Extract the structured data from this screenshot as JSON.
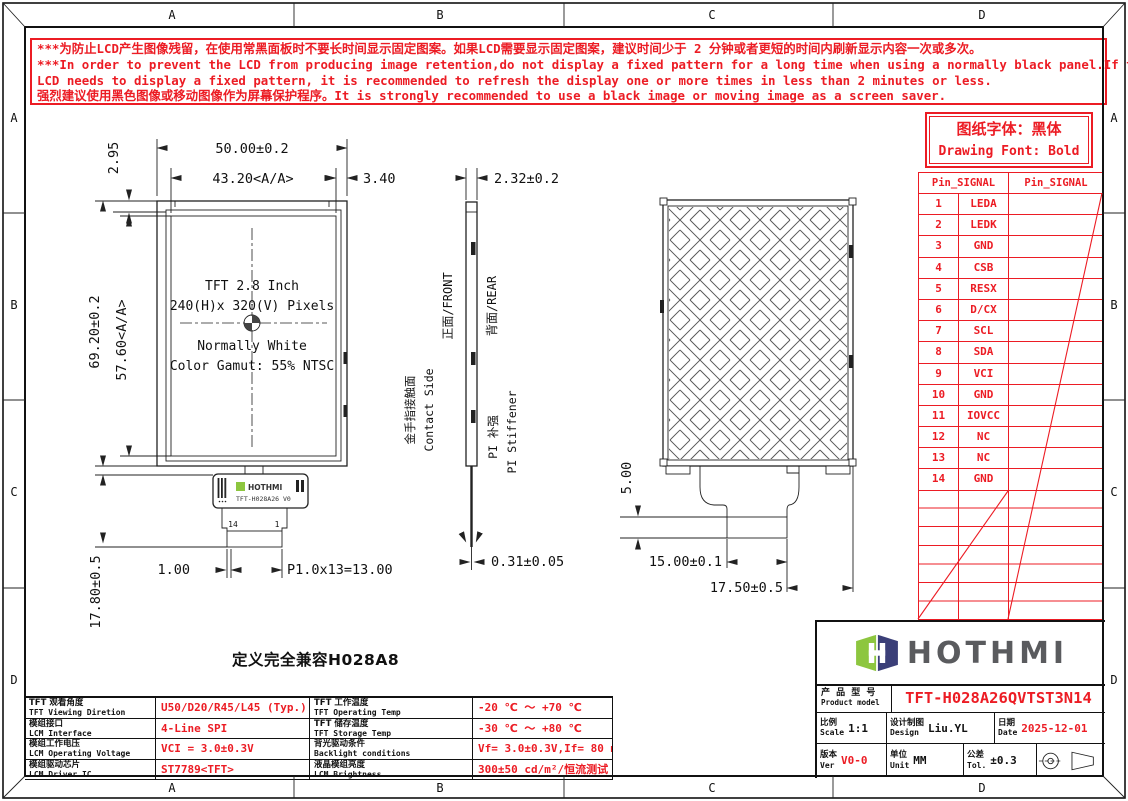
{
  "frame": {
    "zone_cols": [
      "A",
      "B",
      "C",
      "D"
    ],
    "zone_rows": [
      "A",
      "B",
      "C",
      "D"
    ]
  },
  "warning": {
    "lines": [
      "***为防止LCD产生图像残留，在使用常黑面板时不要长时间显示固定图案。如果LCD需要显示固定图案，建议时间少于 2 分钟或者更短的时间内刷新显示内容一次或多次。",
      "***In order to prevent the LCD from producing image retention,do not display a fixed pattern for a long time when using a normally black panel.If the",
      "LCD needs to display a fixed pattern,  it is recommended to refresh the display one or more times in less than 2 minutes or less.",
      "强烈建议使用黑色图像或移动图像作为屏幕保护程序。It is strongly recommended to use a black image or moving image as a screen saver."
    ]
  },
  "font_note": {
    "cn": "图纸字体：黑体",
    "en": "Drawing Font: Bold"
  },
  "pin_table": {
    "header_left": "Pin_SIGNAL",
    "header_right": "Pin_SIGNAL",
    "pins": [
      [
        "1",
        "LEDA"
      ],
      [
        "2",
        "LEDK"
      ],
      [
        "3",
        "GND"
      ],
      [
        "4",
        "CSB"
      ],
      [
        "5",
        "RESX"
      ],
      [
        "6",
        "D/CX"
      ],
      [
        "7",
        "SCL"
      ],
      [
        "8",
        "SDA"
      ],
      [
        "9",
        "VCI"
      ],
      [
        "10",
        "GND"
      ],
      [
        "11",
        "IOVCC"
      ],
      [
        "12",
        "NC"
      ],
      [
        "13",
        "NC"
      ],
      [
        "14",
        "GND"
      ]
    ]
  },
  "front_view": {
    "screen": [
      "TFT 2.8 Inch",
      "240(H)x 320(V) Pixels",
      "Normally White",
      "Color Gamut: 55% NTSC"
    ],
    "dims": {
      "width": "50.00±0.2",
      "aa_width": "43.20<A/A>",
      "top_margin": "2.95",
      "side_margin": "3.40",
      "height": "69.20±0.2",
      "aa_height": "57.60<A/A>",
      "fpc_length": "17.80±0.5",
      "pin_offset": "1.00",
      "pitch": "P1.0x13=13.00"
    },
    "fpc": {
      "brand": "HOTHMI",
      "model": "TFT-H028A26 V0",
      "pin_last": "14",
      "pin_first": "1"
    }
  },
  "side_view": {
    "thickness": "2.32±0.2",
    "fpc_thickness": "0.31±0.05",
    "front_cn": "正面/FRONT",
    "rear_cn": "背面/REAR",
    "contact_cn": "金手指接触面",
    "contact_en": "Contact Side",
    "stiffener_cn": "PI 补强",
    "stiffener_en": "PI Stiffener"
  },
  "rear_view": {
    "dims": {
      "stiffener_h": "5.00",
      "stiffener_w": "15.00±0.1",
      "fpc_offset": "17.50±0.5"
    }
  },
  "compat_note": "定义完全兼容H028A8",
  "spec_table": {
    "rows": [
      {
        "l1": "TFT 观看角度",
        "e1": "TFT Viewing Diretion",
        "v1": "U50/D20/R45/L45 (Typ.)",
        "l2": "TFT 工作温度",
        "e2": "TFT Operating Temp",
        "v2": "-20 ℃ ～ +70 ℃"
      },
      {
        "l1": "模组接口",
        "e1": "LCM Interface",
        "v1": "4-Line SPI",
        "l2": "TFT 储存温度",
        "e2": "TFT Storage Temp",
        "v2": "-30 ℃ ～ +80 ℃"
      },
      {
        "l1": "模组工作电压",
        "e1": "LCM Operating Voltage",
        "v1": "VCI = 3.0±0.3V",
        "l2": "背光驱动条件",
        "e2": "Backlight conditions",
        "v2": "Vf= 3.0±0.3V,If= 80 mA"
      },
      {
        "l1": "模组驱动芯片",
        "e1": "LCM Driver IC",
        "v1": "ST7789<TFT>",
        "l2": "液晶模组亮度",
        "e2": "LCM Brightness",
        "v2": "300±50  cd/m²/恒流测试"
      }
    ]
  },
  "title_block": {
    "brand": "HOTHMI",
    "product_label_cn": "产 品 型 号",
    "product_label_en": "Product model",
    "product_model": "TFT-H028A26QVTST3N14",
    "scale_cn": "比例",
    "scale_en": "Scale",
    "scale": "1:1",
    "design_cn": "设计制图",
    "design_en": "Design",
    "designer": "Liu.YL",
    "date_cn": "日期",
    "date_en": "Date",
    "date": "2025-12-01",
    "ver_cn": "版本",
    "ver_en": "Ver",
    "version": "V0-0",
    "unit_cn": "单位",
    "unit_en": "Unit",
    "unit": "MM",
    "tol_cn": "公差",
    "tol_en": "Tol.",
    "tolerance": "±0.3"
  },
  "colors": {
    "red": "#ec1c24",
    "black": "#1a1a1a",
    "logo_green": "#8dc63f",
    "logo_navy": "#3b3f78",
    "logo_gray": "#5a5b5e"
  }
}
